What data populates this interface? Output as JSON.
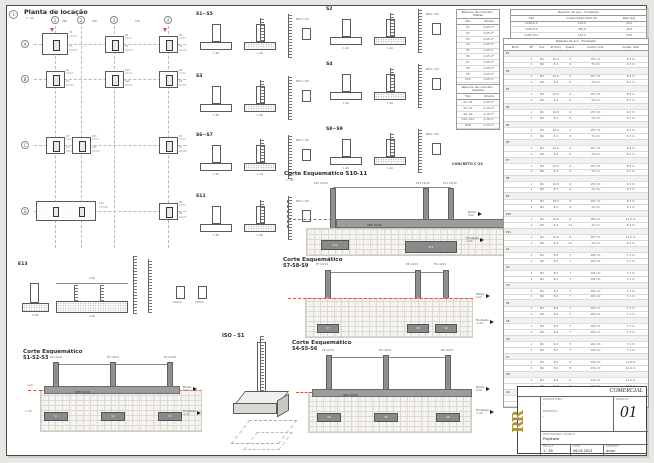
{
  "plan": {
    "marker": "1",
    "title": "Planta de locação",
    "scale": "1 : 25",
    "cols": [
      "1",
      "2",
      "3",
      "4"
    ],
    "rows": [
      "A",
      "B",
      "C",
      "D"
    ],
    "dims": [
      "260",
      "330",
      "540"
    ],
    "col_size": "19/19",
    "footings": [
      {
        "c": 0,
        "r": 0,
        "p": "P1",
        "label": "S1",
        "size": "60x60",
        "big": true
      },
      {
        "c": 2,
        "r": 0,
        "p": "P9",
        "label": "S9",
        "size": "40x60"
      },
      {
        "c": 3,
        "r": 0,
        "p": "P5",
        "label": "S5",
        "size": "40x60"
      },
      {
        "c": 0,
        "r": 1,
        "p": "P2",
        "label": "S2",
        "size": "40x60"
      },
      {
        "c": 2,
        "r": 1,
        "p": "P10",
        "label": "S10",
        "size": "40x60"
      },
      {
        "c": 3,
        "r": 1,
        "p": "P6",
        "label": "S6",
        "size": "40x60"
      },
      {
        "c": 0,
        "r": 2,
        "p": "P3",
        "label": "S3",
        "size": "40x60"
      },
      {
        "c": 1,
        "r": 2,
        "p": "P11",
        "label": "S11",
        "size": "40x60"
      },
      {
        "c": 3,
        "r": 2,
        "p": "P7",
        "label": "S7",
        "size": "40x60"
      },
      {
        "c": 3,
        "r": 3,
        "p": "P8",
        "label": "S8",
        "size": "40x60"
      }
    ],
    "strip": {
      "label": "E13",
      "size": "230x60"
    }
  },
  "details": [
    {
      "id": "S1~S5",
      "dim": "1.20",
      "note": "Ø8.0 c/15"
    },
    {
      "id": "S3",
      "dim": "1.40",
      "note": "Ø8.0 c/15"
    },
    {
      "id": "S6~S7",
      "dim": "1.20",
      "note": "Ø8.0 c/15"
    },
    {
      "id": "S11",
      "dim": "1.40",
      "note": "Ø8.0 c/15"
    },
    {
      "id": "S2",
      "dim": "1.20",
      "note": "Ø8.0 c/15"
    },
    {
      "id": "S4",
      "dim": "1.20",
      "note": "Ø8.0 c/15"
    },
    {
      "id": "S8~S9",
      "dim": "1.40",
      "note": "Ø8.0 c/15"
    }
  ],
  "e13": {
    "id": "E13",
    "dim_top": "2.30",
    "dim_bottom": "2.50",
    "col_dim": "0.60",
    "stirrups": [
      "19x19",
      "19x19"
    ]
  },
  "iso": {
    "label": "ISO - S1"
  },
  "notes": {
    "concrete": "CONCRETO C-25"
  },
  "levels": {
    "top_label": "Térreo",
    "top_elev": "0.00",
    "bottom_label": "Fundação",
    "bottom_elev": "-1.40"
  },
  "cortes": [
    {
      "title": "Corte Esquemático S10-11",
      "scale": "1 : 20",
      "beam": "VB1 15/30",
      "columns": [
        "P10 19/19",
        "P11 19/19",
        "P11 19/19"
      ],
      "footings": [
        "S10",
        "S11"
      ]
    },
    {
      "title": "Corte Esquemático",
      "subtitle": "S7-S8-S9",
      "scale": "1 : 20",
      "columns": [
        "P7 19/19",
        "P8 19/19",
        "P9 19/19"
      ],
      "footings": [
        "S7",
        "S8",
        "S9"
      ]
    },
    {
      "title": "Corte Esquemático",
      "subtitle": "S4-S5-S6",
      "scale": "1 : 20",
      "beam": "VB2 15/30",
      "columns": [
        "P4 19/19",
        "P5 19/19",
        "P6 19/19"
      ],
      "footings": [
        "S4",
        "S5",
        "S6"
      ]
    },
    {
      "title": "Corte Esquemático",
      "subtitle": "S1-S2-S3",
      "scale": "1 : 20",
      "beam": "VB3 15/30",
      "columns": [
        "P1 19/19",
        "P2 19/19",
        "P3 19/19"
      ],
      "footings": [
        "S1",
        "S2",
        "S3"
      ],
      "red_top": "0.00",
      "red_bottom": "-1.40"
    }
  ],
  "tables": {
    "summary": {
      "title": "Resumo de aço - Fundação",
      "header": [
        "Tipo",
        "Comprimento total (m)",
        "Peso (kg)"
      ],
      "rows": [
        [
          "CA50-6.3",
          "110.9",
          "19.2"
        ],
        [
          "CA50-8.0",
          "265.8",
          "46.4"
        ],
        [
          "CA50-10.0",
          "110.2",
          "34.0"
        ]
      ]
    },
    "concrete_pilares": {
      "title": "Resumo de concreto - Pilares",
      "header": [
        "Tipo",
        "Volume"
      ],
      "rows": [
        [
          "P1",
          "0.05 m³"
        ],
        [
          "P2",
          "0.05 m³"
        ],
        [
          "P3",
          "0.05 m³"
        ],
        [
          "P4",
          "0.05 m³"
        ],
        [
          "P5",
          "0.05 m³"
        ],
        [
          "P6",
          "0.05 m³"
        ],
        [
          "P7",
          "0.05 m³"
        ],
        [
          "P8",
          "0.05 m³"
        ],
        [
          "P9",
          "0.05 m³"
        ],
        [
          "P10",
          "0.05 m³"
        ],
        [
          "P11",
          "0.05 m³"
        ],
        [
          "Total",
          "0.55 m³"
        ]
      ]
    },
    "concrete_sapatas": {
      "title": "Resumo de concreto - Sapatas",
      "header": [
        "Tipo",
        "Volume"
      ],
      "rows": [
        [
          "S1~S5",
          "0.22 m³"
        ],
        [
          "S6~S7",
          "0.10 m³"
        ],
        [
          "S8~S9",
          "0.16 m³"
        ],
        [
          "S10~S11",
          "0.26 m³"
        ],
        [
          "Total",
          "0.74 m³"
        ]
      ]
    },
    "relation": {
      "title": "Relação de aço - Fundação",
      "header": [
        "Elem.",
        "Nº",
        "Pos.",
        "Ø (mm)",
        "Quant.",
        "Compr. unit.",
        "Compr. total"
      ],
      "groups": [
        {
          "g": "P1",
          "rows": [
            [
              "1",
              "N1",
              "10.0",
              "4",
              "157 cm",
              "6.3 m"
            ],
            [
              "1",
              "N2",
              "6.3",
              "9",
              "74 cm",
              "6.7 m"
            ]
          ]
        },
        {
          "g": "P2",
          "rows": [
            [
              "1",
              "N1",
              "10.0",
              "4",
              "157 cm",
              "6.3 m"
            ],
            [
              "1",
              "N2",
              "6.3",
              "9",
              "74 cm",
              "6.7 m"
            ]
          ]
        },
        {
          "g": "P3",
          "rows": [
            [
              "1",
              "N1",
              "10.0",
              "4",
              "157 cm",
              "6.3 m"
            ],
            [
              "1",
              "N2",
              "6.3",
              "9",
              "74 cm",
              "6.7 m"
            ]
          ]
        },
        {
          "g": "P4",
          "rows": [
            [
              "1",
              "N1",
              "10.0",
              "4",
              "157 cm",
              "6.3 m"
            ],
            [
              "1",
              "N2",
              "6.3",
              "9",
              "74 cm",
              "6.7 m"
            ]
          ]
        },
        {
          "g": "P5",
          "rows": [
            [
              "1",
              "N1",
              "10.0",
              "4",
              "157 cm",
              "6.3 m"
            ],
            [
              "1",
              "N2",
              "6.3",
              "9",
              "74 cm",
              "6.7 m"
            ]
          ]
        },
        {
          "g": "P6",
          "rows": [
            [
              "1",
              "N1",
              "10.0",
              "4",
              "157 cm",
              "6.3 m"
            ],
            [
              "1",
              "N2",
              "6.3",
              "9",
              "74 cm",
              "6.7 m"
            ]
          ]
        },
        {
          "g": "P7",
          "rows": [
            [
              "1",
              "N1",
              "10.0",
              "4",
              "157 cm",
              "6.3 m"
            ],
            [
              "1",
              "N2",
              "6.3",
              "9",
              "74 cm",
              "6.7 m"
            ]
          ]
        },
        {
          "g": "P8",
          "rows": [
            [
              "1",
              "N1",
              "10.0",
              "4",
              "157 cm",
              "6.3 m"
            ],
            [
              "1",
              "N2",
              "6.3",
              "9",
              "74 cm",
              "6.7 m"
            ]
          ]
        },
        {
          "g": "P9",
          "rows": [
            [
              "1",
              "N1",
              "10.0",
              "4",
              "157 cm",
              "6.3 m"
            ],
            [
              "1",
              "N2",
              "6.3",
              "9",
              "74 cm",
              "6.7 m"
            ]
          ]
        },
        {
          "g": "P10",
          "rows": [
            [
              "1",
              "N1",
              "10.0",
              "6",
              "187 cm",
              "11.2 m"
            ],
            [
              "1",
              "N2",
              "6.3",
              "11",
              "74 cm",
              "8.1 m"
            ]
          ]
        },
        {
          "g": "P11",
          "rows": [
            [
              "1",
              "N1",
              "10.0",
              "6",
              "187 cm",
              "11.2 m"
            ],
            [
              "1",
              "N2",
              "6.3",
              "11",
              "74 cm",
              "8.1 m"
            ]
          ]
        },
        {
          "g": "S1",
          "rows": [
            [
              "1",
              "N1",
              "8.0",
              "7",
              "102 cm",
              "7.1 m"
            ],
            [
              "1",
              "N2",
              "8.0",
              "7",
              "102 cm",
              "7.1 m"
            ]
          ]
        },
        {
          "g": "S2",
          "rows": [
            [
              "1",
              "N1",
              "8.0",
              "7",
              "102 cm",
              "7.1 m"
            ],
            [
              "1",
              "N2",
              "8.0",
              "7",
              "102 cm",
              "7.1 m"
            ]
          ]
        },
        {
          "g": "S3",
          "rows": [
            [
              "1",
              "N1",
              "8.0",
              "7",
              "102 cm",
              "7.1 m"
            ],
            [
              "1",
              "N2",
              "8.0",
              "7",
              "102 cm",
              "7.1 m"
            ]
          ]
        },
        {
          "g": "S4",
          "rows": [
            [
              "1",
              "N1",
              "8.0",
              "7",
              "102 cm",
              "7.1 m"
            ],
            [
              "1",
              "N2",
              "8.0",
              "7",
              "102 cm",
              "7.1 m"
            ]
          ]
        },
        {
          "g": "S5",
          "rows": [
            [
              "1",
              "N1",
              "8.0",
              "7",
              "102 cm",
              "7.1 m"
            ],
            [
              "1",
              "N2",
              "8.0",
              "7",
              "102 cm",
              "7.1 m"
            ]
          ]
        },
        {
          "g": "S6",
          "rows": [
            [
              "1",
              "N1",
              "8.0",
              "7",
              "102 cm",
              "7.1 m"
            ],
            [
              "1",
              "N2",
              "8.0",
              "7",
              "102 cm",
              "7.1 m"
            ]
          ]
        },
        {
          "g": "S7",
          "rows": [
            [
              "1",
              "N1",
              "8.0",
              "9",
              "132 cm",
              "11.9 m"
            ],
            [
              "1",
              "N2",
              "8.0",
              "9",
              "132 cm",
              "11.9 m"
            ]
          ]
        },
        {
          "g": "S8",
          "rows": [
            [
              "1",
              "N1",
              "8.0",
              "9",
              "132 cm",
              "11.9 m"
            ],
            [
              "1",
              "N2",
              "8.0",
              "9",
              "132 cm",
              "11.9 m"
            ]
          ]
        },
        {
          "g": "S9",
          "rows": [
            [
              "1",
              "N1",
              "8.0",
              "9",
              "132 cm",
              "11.9 m"
            ],
            [
              "1",
              "N2",
              "8.0",
              "9",
              "132 cm",
              "11.9 m"
            ]
          ]
        }
      ]
    }
  },
  "titleblock": {
    "doc_title": "COMERCIAL",
    "logo": "RR",
    "owner_label": "PROPRIETÁRIO",
    "owner_value": "-",
    "address_label": "ENDEREÇO",
    "address_value": "-",
    "sheet_label": "PRANCHA",
    "sheet_number": "01",
    "prof_label": "PROFISSIONAL TÉCNICO",
    "prof_value": "Projetista",
    "scale_label": "ESCALA",
    "scale_value": "1 : 50",
    "date_label": "DATA",
    "date_value": "06.05.2023",
    "drawn_label": "DESENHO",
    "drawn_value": "Autor"
  }
}
